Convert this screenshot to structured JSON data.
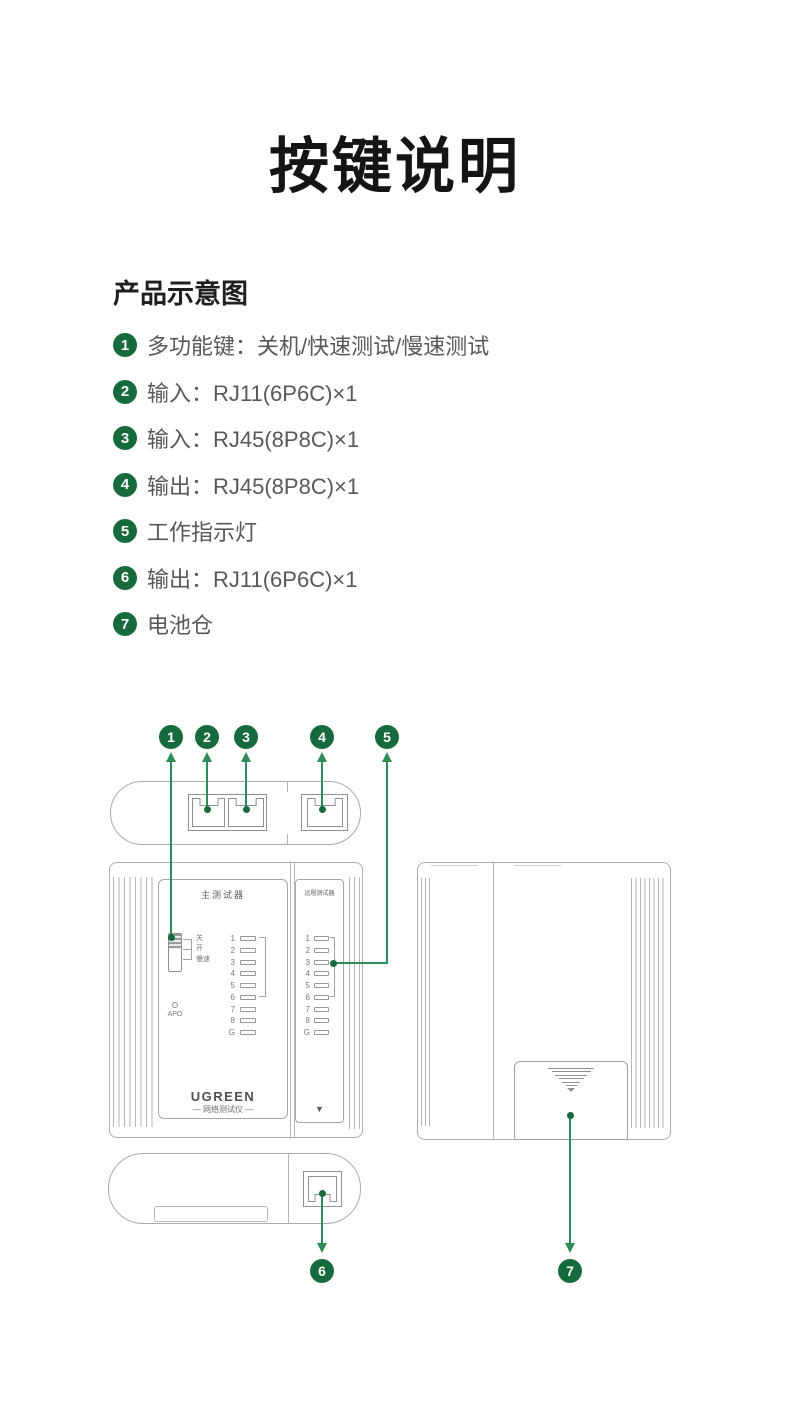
{
  "page": {
    "title": "按键说明",
    "section_heading": "产品示意图",
    "background": "#ffffff"
  },
  "legend": {
    "items": [
      {
        "num": "1",
        "text": "多功能键：关机/快速测试/慢速测试"
      },
      {
        "num": "2",
        "text": "输入：RJ11(6P6C)×1"
      },
      {
        "num": "3",
        "text": "输入：RJ45(8P8C)×1"
      },
      {
        "num": "4",
        "text": "输出：RJ45(8P8C)×1"
      },
      {
        "num": "5",
        "text": "工作指示灯"
      },
      {
        "num": "6",
        "text": "输出：RJ11(6P6C)×1"
      },
      {
        "num": "7",
        "text": "电池仓"
      }
    ]
  },
  "diagram": {
    "callouts": [
      "1",
      "2",
      "3",
      "4",
      "5",
      "6",
      "7"
    ],
    "front_view": {
      "main_panel_label": "主测试器",
      "remote_panel_label": "远程测试器",
      "switch_labels": [
        "关",
        "开",
        "慢速"
      ],
      "apo_label": "APO",
      "led_labels": [
        "1",
        "2",
        "3",
        "4",
        "5",
        "6",
        "7",
        "8",
        "G"
      ],
      "brand": "UGREEN",
      "brand_subtitle": "— 网络测试仪 —",
      "remote_bottom_arrow": "▼"
    },
    "colors": {
      "badge_green": "#176A3C",
      "callout_line_green": "#2E8C57",
      "outline_gray": "#A9ABAE"
    }
  }
}
